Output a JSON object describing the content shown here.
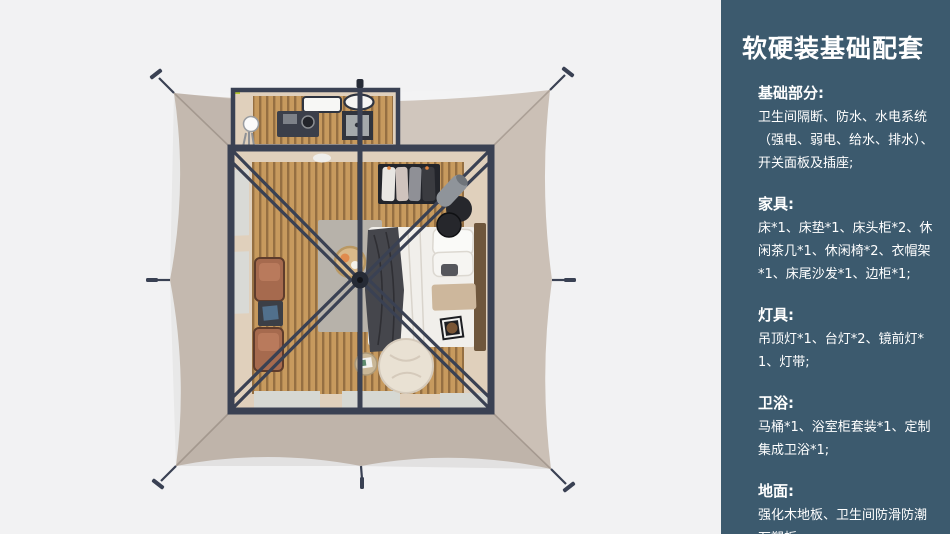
{
  "colors": {
    "page_bg": "#f2f2f3",
    "sidebar_bg": "#3c5a6e",
    "canvas": "#cbc0b6",
    "frame": "#3a4153",
    "wood": "#c79a5e",
    "wood_groove": "#6b4c2c",
    "wall": "#e0d0bc",
    "rug": "#b7b2aa",
    "bed": "#f1efeb",
    "throw": "#45464c",
    "chair": "#a66a4e",
    "pouf": "#26272c",
    "beanbag": "#e9e1d3",
    "heater": "#8f949a",
    "mat": "#d6d8d3",
    "window": "#d9dad6",
    "accent": "#b5c832"
  },
  "sidebar": {
    "title": "软硬装基础配套",
    "sections": [
      {
        "heading": "基础部分:",
        "body": "卫生间隔断、防水、水电系统（强电、弱电、给水、排水）、开关面板及插座;"
      },
      {
        "heading": "家具:",
        "body": "床*1、床垫*1、床头柜*2、休闲茶几*1、休闲椅*2、衣帽架*1、床尾沙发*1、边柜*1;"
      },
      {
        "heading": "灯具:",
        "body": "吊顶灯*1、台灯*2、镜前灯*1、灯带;"
      },
      {
        "heading": "卫浴:",
        "body": "马桶*1、浴室柜套装*1、定制集成卫浴*1;"
      },
      {
        "heading": "地面:",
        "body": "强化木地板、卫生间防滑防潮石塑板;"
      }
    ]
  }
}
